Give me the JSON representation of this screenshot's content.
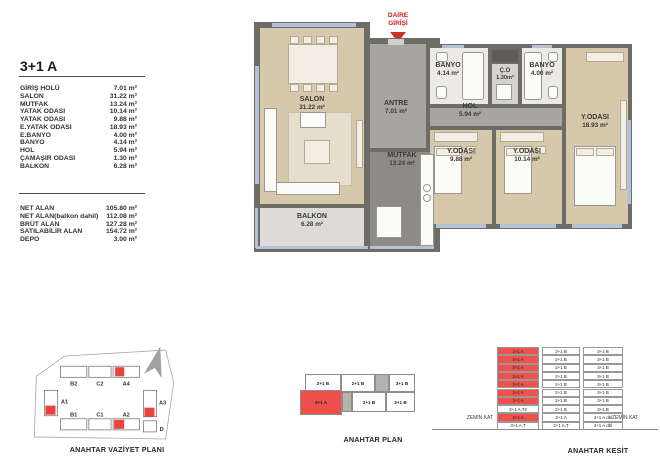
{
  "title": "3+1 A",
  "room_list": [
    {
      "label": "GİRİŞ HOLÜ",
      "value": "7.01 m²"
    },
    {
      "label": "SALON",
      "value": "31.22 m²"
    },
    {
      "label": "MUTFAK",
      "value": "13.24 m²"
    },
    {
      "label": "YATAK ODASI",
      "value": "10.14 m²"
    },
    {
      "label": "YATAK ODASI",
      "value": "9.88 m²"
    },
    {
      "label": "E.YATAK ODASI",
      "value": "18.93 m²"
    },
    {
      "label": "E.BANYO",
      "value": "4.00 m²"
    },
    {
      "label": "BANYO",
      "value": "4.14 m²"
    },
    {
      "label": "HOL",
      "value": "5.94 m²"
    },
    {
      "label": "ÇAMAŞIR ODASI",
      "value": "1.30 m²"
    },
    {
      "label": "BALKON",
      "value": "6.28 m²"
    }
  ],
  "totals": [
    {
      "label": "NET ALAN",
      "value": "105.80 m²"
    },
    {
      "label": "NET ALAN(balkon dahil)",
      "value": "112.08 m²"
    },
    {
      "label": "BRÜT ALAN",
      "value": "127.28 m²"
    },
    {
      "label": "SATILABİLİR ALAN",
      "value": "154.72 m²"
    },
    {
      "label": "DEPO",
      "value": "3.00 m²"
    }
  ],
  "entrance": {
    "line1": "DAİRE",
    "line2": "GİRİŞİ"
  },
  "plan": {
    "salon": {
      "name": "SALON",
      "area": "31.22 m²"
    },
    "balkon": {
      "name": "BALKON",
      "area": "6.28 m²"
    },
    "antre": {
      "name": "ANTRE",
      "area": "7.01 m²"
    },
    "mutfak": {
      "name": "MUTFAK",
      "area": "13.24 m²"
    },
    "banyo1": {
      "name": "BANYO",
      "area": "4.14 m²"
    },
    "co": {
      "name": "Ç.O",
      "area": "1.30m²"
    },
    "banyo2": {
      "name": "BANYO",
      "area": "4.00 m²"
    },
    "hol": {
      "name": "HOL",
      "area": "5.94 m²"
    },
    "bed1": {
      "name": "Y.ODASI",
      "area": "9.88 m²"
    },
    "bed2": {
      "name": "Y.ODASI",
      "area": "10.14 m²"
    },
    "bed3": {
      "name": "Y.ODASI",
      "area": "18.93 m²"
    }
  },
  "site_plan": {
    "caption": "ANAHTAR VAZİYET PLANI",
    "buildings": {
      "b2": "B2",
      "c2": "C2",
      "a4": "A4",
      "a1": "A1",
      "a3": "A3",
      "b1": "B1",
      "c1": "C1",
      "a2": "A2",
      "d": "D"
    }
  },
  "key_plan": {
    "caption": "ANAHTAR PLAN",
    "top": [
      "2+1 B",
      "2+1 B",
      "3+1 B"
    ],
    "bottom": [
      "3+1 A",
      "2+1 B",
      "3+1 B"
    ]
  },
  "section": {
    "caption": "ANAHTAR KESİT",
    "ground_left": "ZEMİN KAT",
    "ground_right": "ZEMİN KAT",
    "rows": [
      [
        "3+1 A",
        "2+1 B",
        "3+1 B"
      ],
      [
        "3+1 A",
        "2+1 B",
        "3+1 B"
      ],
      [
        "3+1 A",
        "2+1 B",
        "3+1 B"
      ],
      [
        "3+1 A",
        "2+1 B",
        "3+1 B"
      ],
      [
        "3+1 A",
        "2+1 B",
        "3+1 B"
      ],
      [
        "3+1 A",
        "2+1 B",
        "3+1 B"
      ],
      [
        "3+1 A",
        "2+1 B",
        "3+1 B"
      ],
      [
        "3+1 A.T2",
        "2+1 B",
        "3+1 B"
      ],
      [
        "3+1 A",
        "2+1 A",
        "4+1 A.dbl"
      ],
      [
        "3+1 A.T",
        "2+1 A.T",
        "4+1 A.dbl"
      ]
    ]
  },
  "colors": {
    "accent_red": "#ee4f4b",
    "wall_gray": "#6f6c68",
    "window_blue": "#b3c2d7"
  }
}
